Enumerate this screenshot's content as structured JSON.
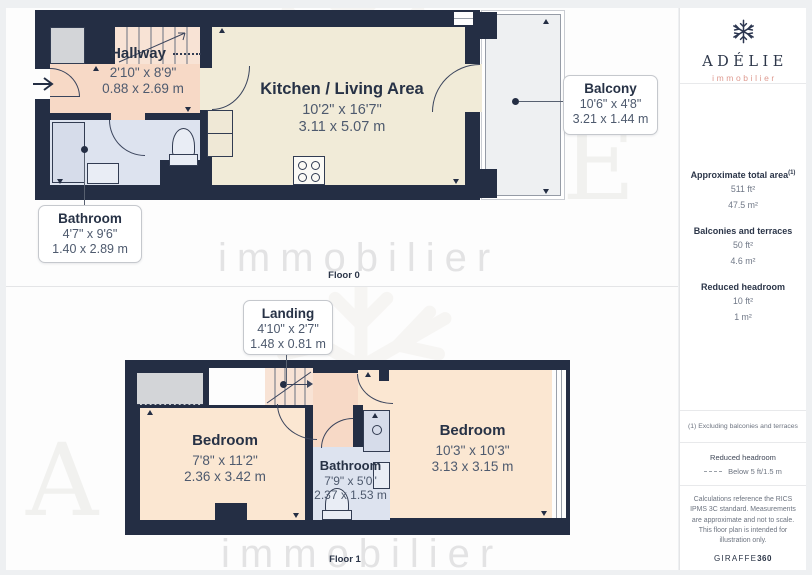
{
  "watermark": {
    "brand": "ADÉLIE",
    "tagline": "immobilier"
  },
  "floor0": {
    "label": "Floor 0",
    "hallway": {
      "name": "Hallway",
      "imperial": "2'10\" x 8'9\"",
      "metric": "0.88 x 2.69 m"
    },
    "kitchen": {
      "name": "Kitchen / Living Area",
      "imperial": "10'2\" x 16'7\"",
      "metric": "3.11 x 5.07 m"
    },
    "balcony": {
      "name": "Balcony",
      "imperial": "10'6\" x 4'8\"",
      "metric": "3.21 x 1.44 m"
    },
    "bathroom": {
      "name": "Bathroom",
      "imperial": "4'7\" x 9'6\"",
      "metric": "1.40 x 2.89 m"
    }
  },
  "floor1": {
    "label": "Floor 1",
    "landing": {
      "name": "Landing",
      "imperial": "4'10\" x 2'7\"",
      "metric": "1.48 x 0.81 m"
    },
    "bedroom_left": {
      "name": "Bedroom",
      "imperial": "7'8\" x 11'2\"",
      "metric": "2.36 x 3.42 m"
    },
    "bedroom_right": {
      "name": "Bedroom",
      "imperial": "10'3\" x 10'3\"",
      "metric": "3.13 x 3.15 m"
    },
    "bathroom": {
      "name": "Bathroom",
      "imperial": "7'9\" x 5'0\"",
      "metric": "2.37 x 1.53 m"
    }
  },
  "sidebar": {
    "brand": {
      "name": "ADÉLIE",
      "tagline": "immobilier"
    },
    "total": {
      "label": "Approximate total area",
      "sup": "(1)",
      "ft": "511 ft²",
      "m": "47.5 m²"
    },
    "balconies": {
      "label": "Balconies and terraces",
      "ft": "50 ft²",
      "m": "4.6 m²"
    },
    "reduced": {
      "label": "Reduced headroom",
      "ft": "10 ft²",
      "m": "1 m²"
    },
    "note": "(1) Excluding balconies and terraces",
    "legend": {
      "title": "Reduced headroom",
      "item": "Below 5 ft/1.5 m"
    },
    "disclaimer": "Calculations reference the RICS IPMS 3C standard. Measurements are approximate and not to scale. This floor plan is intended for illustration only.",
    "footer": {
      "giraffe": "GIRAFFE",
      "suffix": "360"
    }
  },
  "colors": {
    "wall": "#242e44",
    "hallway": "#f7d9c6",
    "kitchen": "#f1ebd8",
    "bedroom": "#fbe7d2",
    "bathroom": "#dde3ef",
    "balcony": "#eef0f2",
    "reduced_headroom": "#d3d5d8",
    "brand_accent": "#de9a90"
  }
}
